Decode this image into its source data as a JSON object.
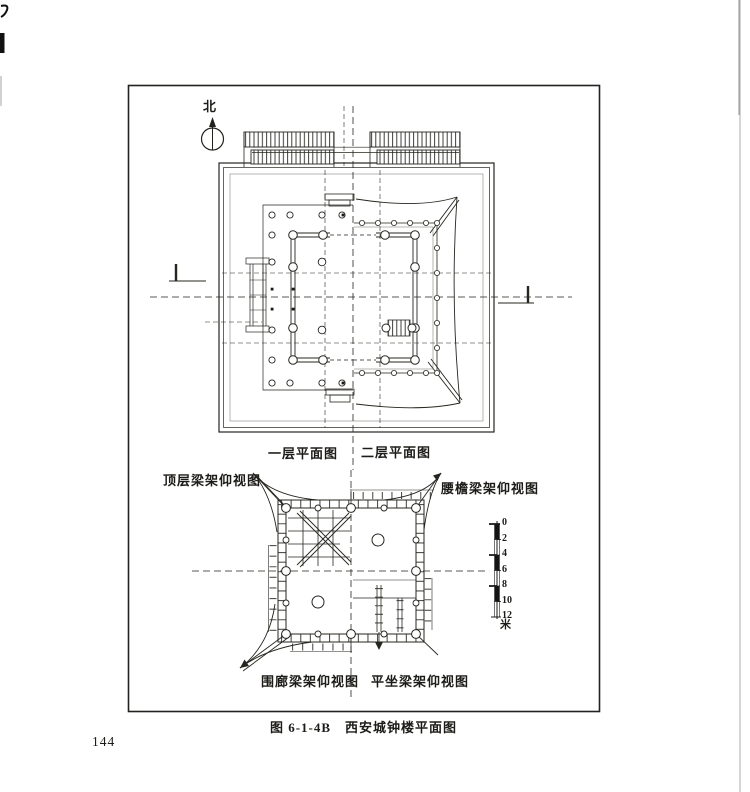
{
  "page": {
    "number": "144",
    "colors": {
      "paper": "#ffffff",
      "ink": "#1c1b18"
    }
  },
  "figure": {
    "caption_number": "图 6-1-4B",
    "caption_title": "西安城钟楼平面图",
    "north_label": "北",
    "top_plan": {
      "left_half_label": "一层平面图",
      "right_half_label": "二层平面图"
    },
    "bottom_plan": {
      "top_left_label": "顶层梁架仰视图",
      "top_right_label": "腰檐梁架仰视图",
      "bottom_left_label": "围廊梁架仰视图",
      "bottom_right_label": "平坐梁架仰视图"
    },
    "scale_bar": {
      "labels": [
        "0",
        "2",
        "4",
        "6",
        "8",
        "10",
        "12"
      ],
      "unit": "米"
    }
  }
}
